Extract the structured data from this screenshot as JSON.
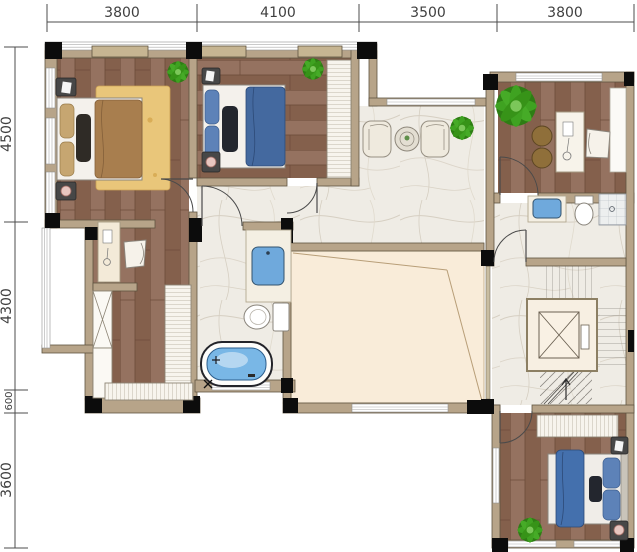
{
  "dimensions": {
    "top": [
      "3800",
      "4100",
      "3500",
      "3800"
    ],
    "left": [
      "4500",
      "4300",
      "600",
      "3600"
    ]
  },
  "colors": {
    "wall": "#b7a489",
    "wall_stroke": "#5f5440",
    "lintel": "#c6b592",
    "column": "#0c0c0c",
    "wood": "#8d6955",
    "wood_line": "#6b4a39",
    "marble": "#efece5",
    "void_floor": "#f9ecd9",
    "rug": "#e9c67a",
    "bed_brown_blanket": "#a87e4e",
    "bed_blue_blanket": "#44699f",
    "pillow_blue": "#5d82b8",
    "pillow_dark": "#26262a",
    "tub_water": "#79b7e6",
    "sink_blue": "#6fa9dc",
    "plant_green": "#3fa221",
    "stool_brown": "#8f6f3a",
    "dimension_text": "#3f3f3f"
  },
  "rooms": [
    "master-bedroom",
    "bedroom-2",
    "terrace",
    "study",
    "hallway",
    "bathroom-main",
    "bathroom-2",
    "dressing-area",
    "walk-in-closet",
    "void-over-living-room",
    "elevator",
    "staircase",
    "bedroom-3"
  ],
  "fixtures": [
    "double-bed-brown",
    "double-bed-blue",
    "double-bed-blue-2",
    "area-rug",
    "nightstand",
    "table-lamp",
    "potted-plant",
    "wardrobe",
    "x-closet",
    "vanity-desk",
    "desk-chair",
    "lounge-chair",
    "round-table",
    "stool",
    "bathtub",
    "toilet",
    "wash-basin",
    "shower",
    "elevator-cab",
    "stair-treads",
    "door-swing"
  ]
}
